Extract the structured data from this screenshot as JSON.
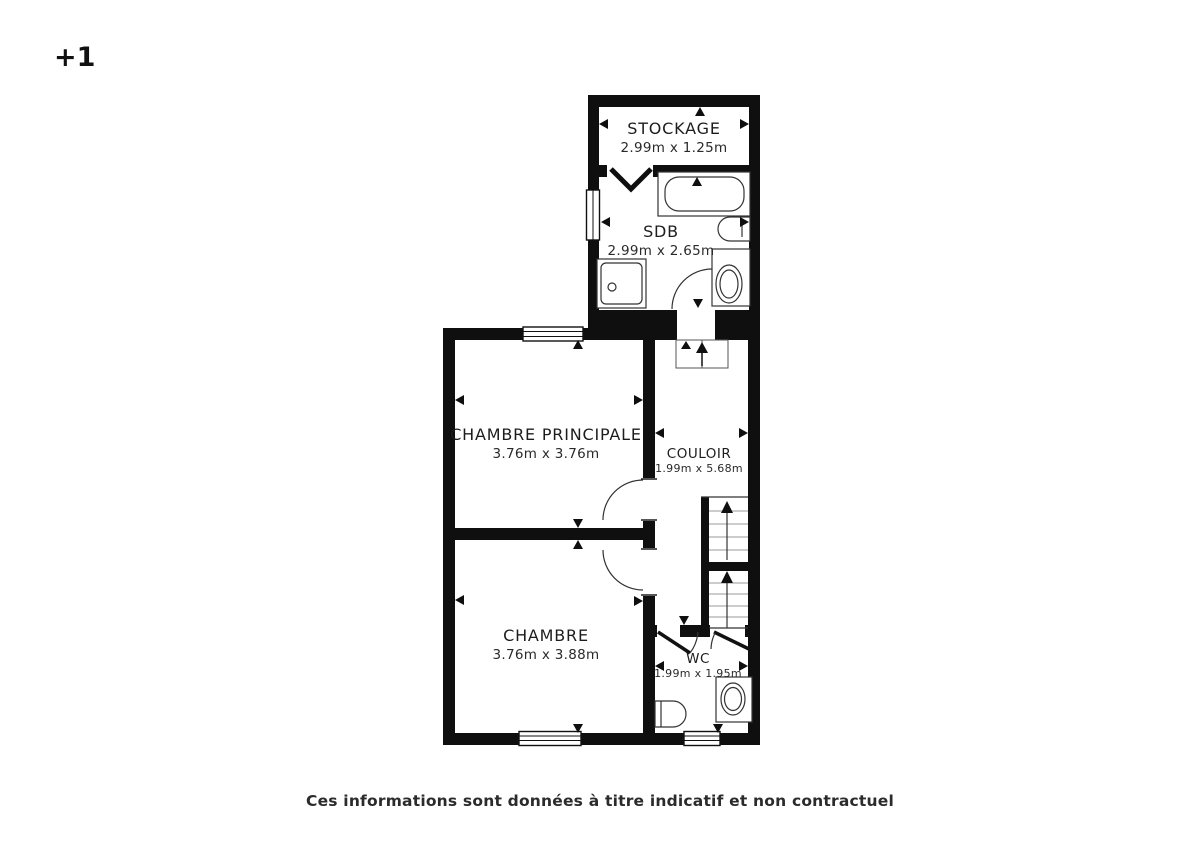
{
  "floor_label": "+1",
  "disclaimer": "Ces informations sont données à titre indicatif et non contractuel",
  "rooms": {
    "stockage": {
      "name": "STOCKAGE",
      "dims": "2.99m x 1.25m"
    },
    "sdb": {
      "name": "SDB",
      "dims": "2.99m x 2.65m"
    },
    "chambre_principale": {
      "name": "CHAMBRE PRINCIPALE",
      "dims": "3.76m x 3.76m"
    },
    "couloir": {
      "name": "COULOIR",
      "dims": "1.99m x 5.68m"
    },
    "chambre": {
      "name": "CHAMBRE",
      "dims": "3.76m x 3.88m"
    },
    "wc": {
      "name": "WC",
      "dims": "1.99m x 1.95m"
    }
  },
  "colors": {
    "wall": "#0f0f0f",
    "line": "#333333",
    "text": "#1d1d1d",
    "background": "#ffffff"
  }
}
